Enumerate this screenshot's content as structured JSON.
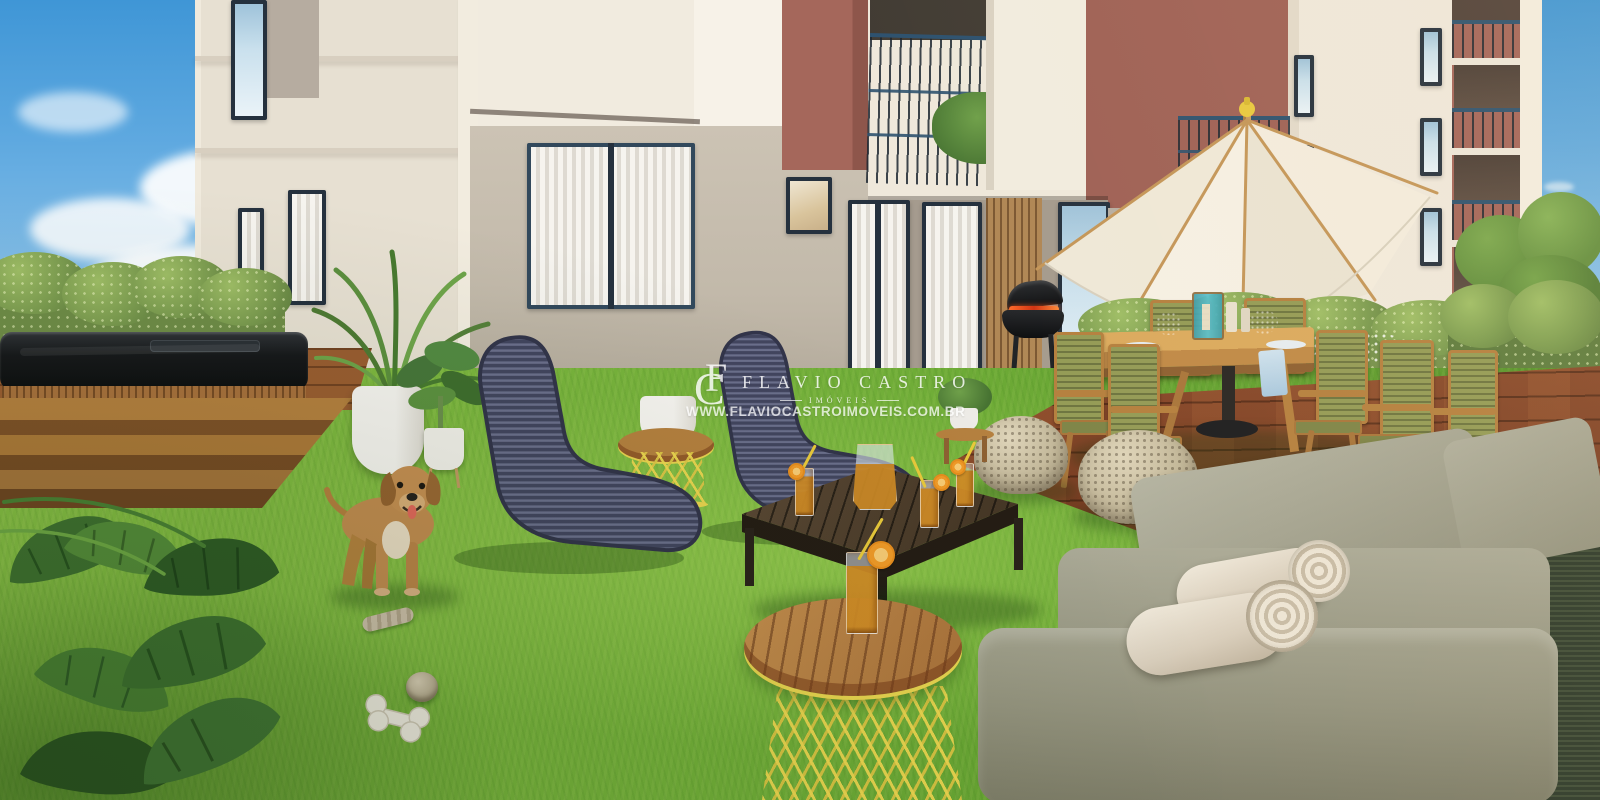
{
  "watermark": {
    "monogram_f": "F",
    "monogram_c": "C",
    "brand": "FLAVIO CASTRO",
    "tagline": "IMÓVEIS",
    "url": "WWW.FLAVIOCASTROIMOVEIS.COM.BR"
  },
  "palette": {
    "sky_top": "#3F96D6",
    "sky_horizon": "#DFF0FA",
    "facade_cream": "#F1EBDF",
    "facade_greige": "#C6BDAE",
    "terracotta": "#A5675B",
    "window_frame": "#25313E",
    "railing_blue": "#2E526F",
    "grass_green": "#74B13A",
    "deck_wood": "#8A4A2B",
    "hedge_green": "#7C9C50",
    "lounge_navy": "#44475F",
    "accent_yellow": "#E9D44F",
    "iced_tea_amber": "#D08B26",
    "pouf_beige": "#C3B89A",
    "sofa_gray": "#9A9985",
    "rattan_dark": "#2E3A2B",
    "umbrella_cream": "#F5EFE3",
    "dog_coat": "#C28C50",
    "watermark_white": "#FFFFFF"
  }
}
